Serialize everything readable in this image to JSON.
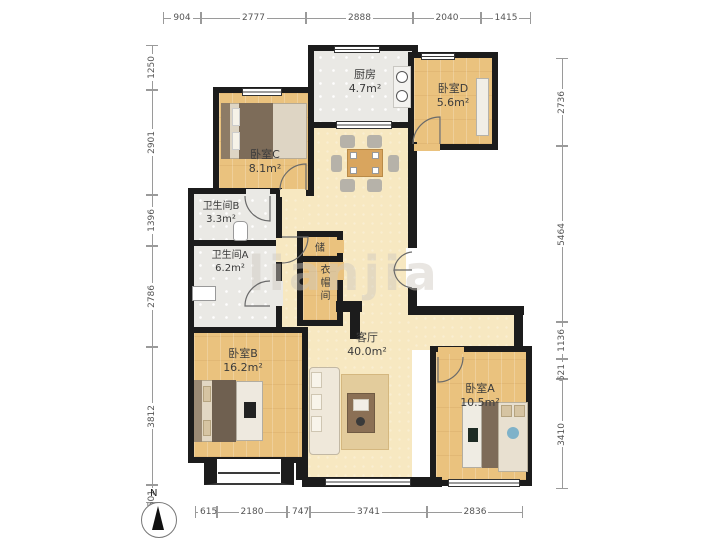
{
  "compass": {
    "label": "N"
  },
  "watermark": "lianjia",
  "rooms": {
    "kitchen": {
      "name": "厨房",
      "area": "4.7m²"
    },
    "bedroom_d": {
      "name": "卧室D",
      "area": "5.6m²"
    },
    "bedroom_c": {
      "name": "卧室C",
      "area": "8.1m²"
    },
    "bathroom_b": {
      "name": "卫生间B",
      "area": "3.3m²"
    },
    "bathroom_a": {
      "name": "卫生间A",
      "area": "6.2m²"
    },
    "bedroom_b": {
      "name": "卧室B",
      "area": "16.2m²"
    },
    "living_room": {
      "name": "客厅",
      "area": "40.0m²"
    },
    "bedroom_a": {
      "name": "卧室A",
      "area": "10.5m²"
    },
    "storage": {
      "name": "储"
    },
    "cloakroom": {
      "name": "衣帽间"
    }
  },
  "dimensions_mm": {
    "top": [
      "904",
      "2777",
      "2888",
      "2040",
      "1415"
    ],
    "left": [
      "1250",
      "2901",
      "1396",
      "2786",
      "3812",
      "501"
    ],
    "right": [
      "2736",
      "5464",
      "1136",
      "621",
      "3410"
    ],
    "bottom": [
      "615",
      "2180",
      "747",
      "3741",
      "2836"
    ]
  },
  "colors": {
    "wall": "#1c1c1c",
    "wood_floor": "#eac27e",
    "tile_floor": "#eae9e5",
    "living_floor": "#f7e8c1"
  }
}
